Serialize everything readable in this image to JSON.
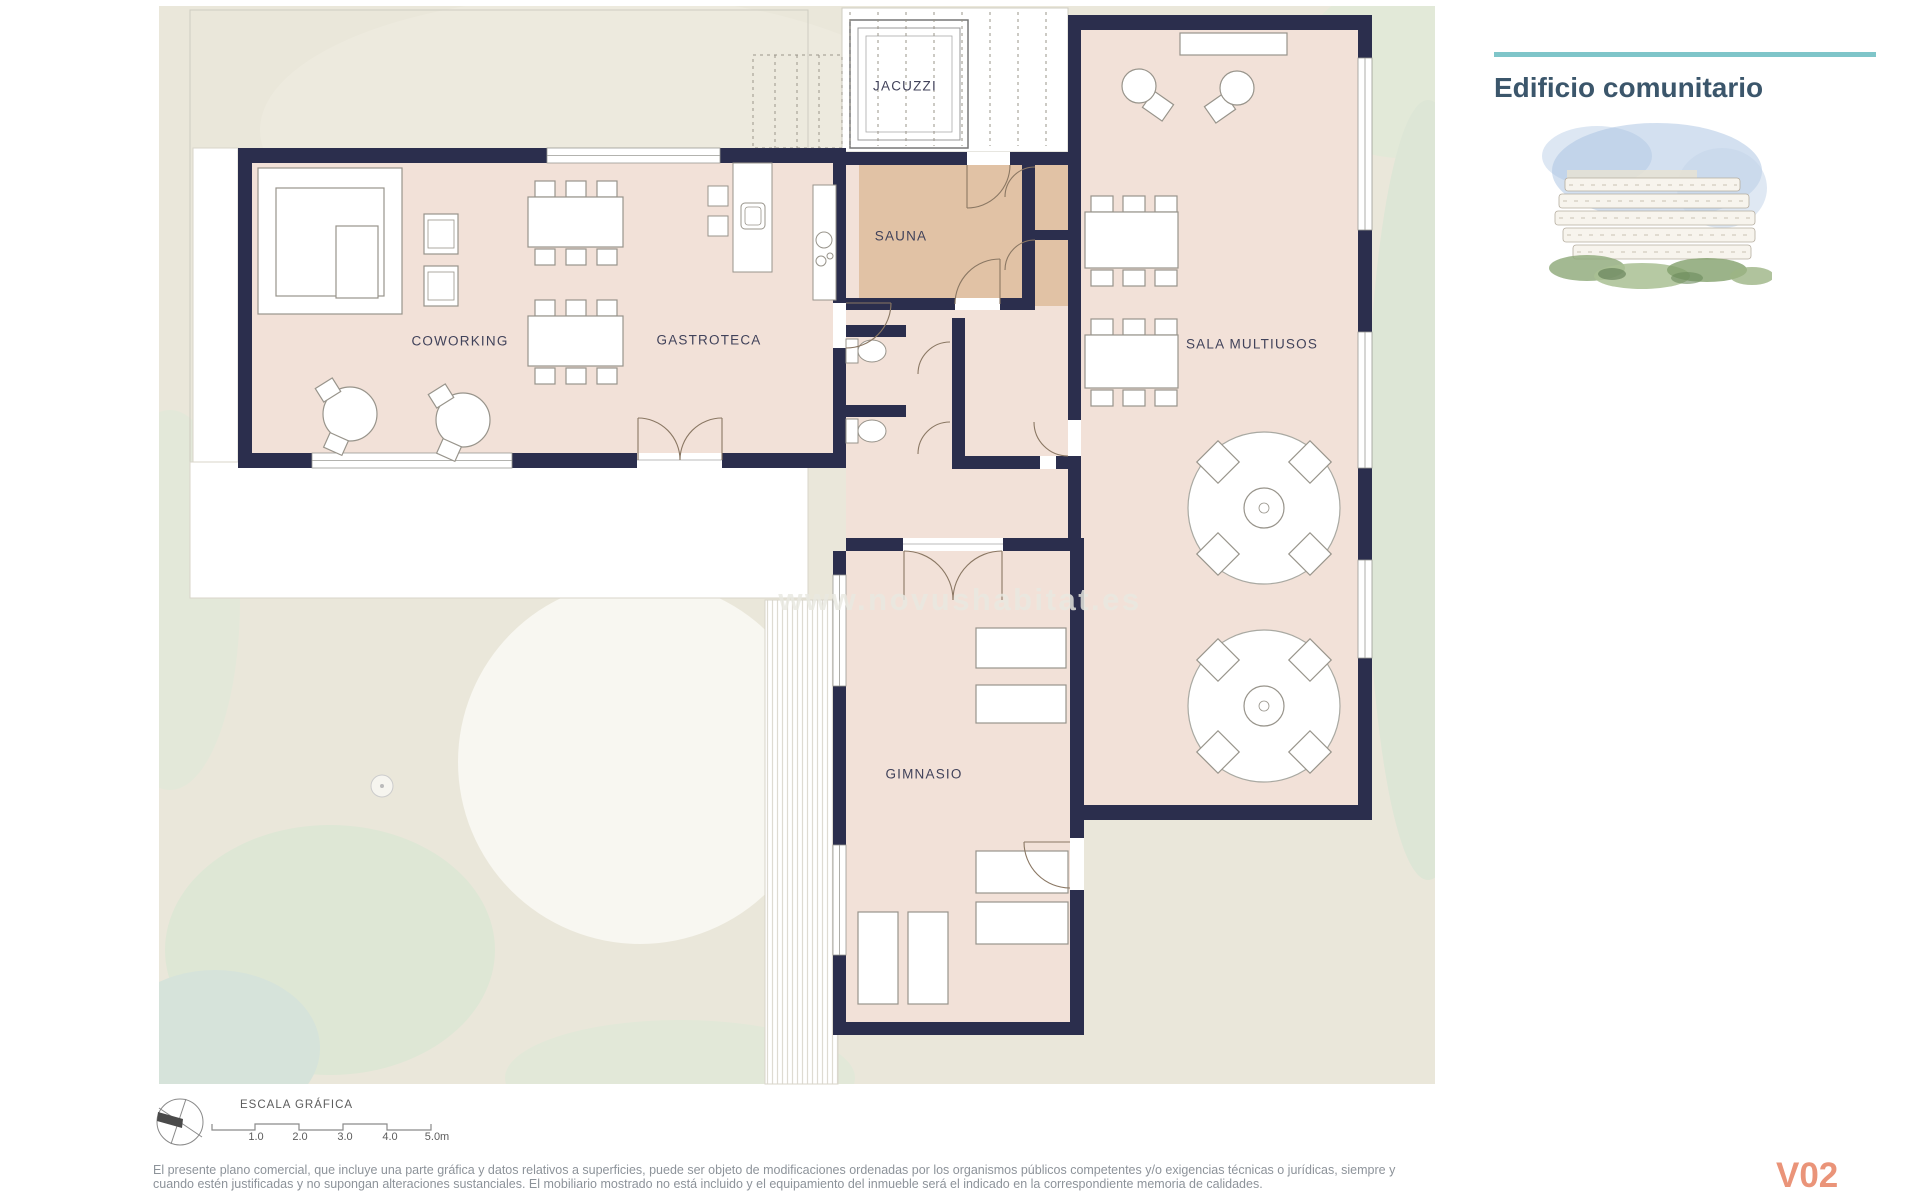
{
  "header": {
    "title": "Edificio comunitario"
  },
  "plan": {
    "watermark": "www.novushabitat.es",
    "rooms": {
      "coworking": "COWORKING",
      "gastroteca": "GASTROTECA",
      "sauna": "SAUNA",
      "jacuzzi": "JACUZZI",
      "sala_multiusos": "SALA MULTIUSOS",
      "gimnasio": "GIMNASIO"
    }
  },
  "scale_bar": {
    "title": "ESCALA GRÁFICA",
    "ticks": [
      "1.0",
      "2.0",
      "3.0",
      "4.0",
      "5.0m"
    ]
  },
  "footer": {
    "disclaimer_line1": "El presente plano comercial, que incluye una parte gráfica y datos relativos a superficies, puede ser objeto de modificaciones ordenadas por los organismos públicos competentes y/o exigencias técnicas o jurídicas, siempre y",
    "disclaimer_line2": "cuando estén justificadas y no supongan alteraciones sustanciales. El mobiliario mostrado no está incluido y el equipamiento del inmueble será el indicado en la correspondiente memoria de calidades.",
    "version": "V02"
  },
  "colors": {
    "wall": "#2b2e4d",
    "floor": "#f2e1d8",
    "sauna_floor": "#e1c2a5",
    "site": "#eae7da",
    "accent_teal": "#7fc5c9",
    "title_blue": "#3b566b",
    "version_salmon": "#ea9479"
  }
}
